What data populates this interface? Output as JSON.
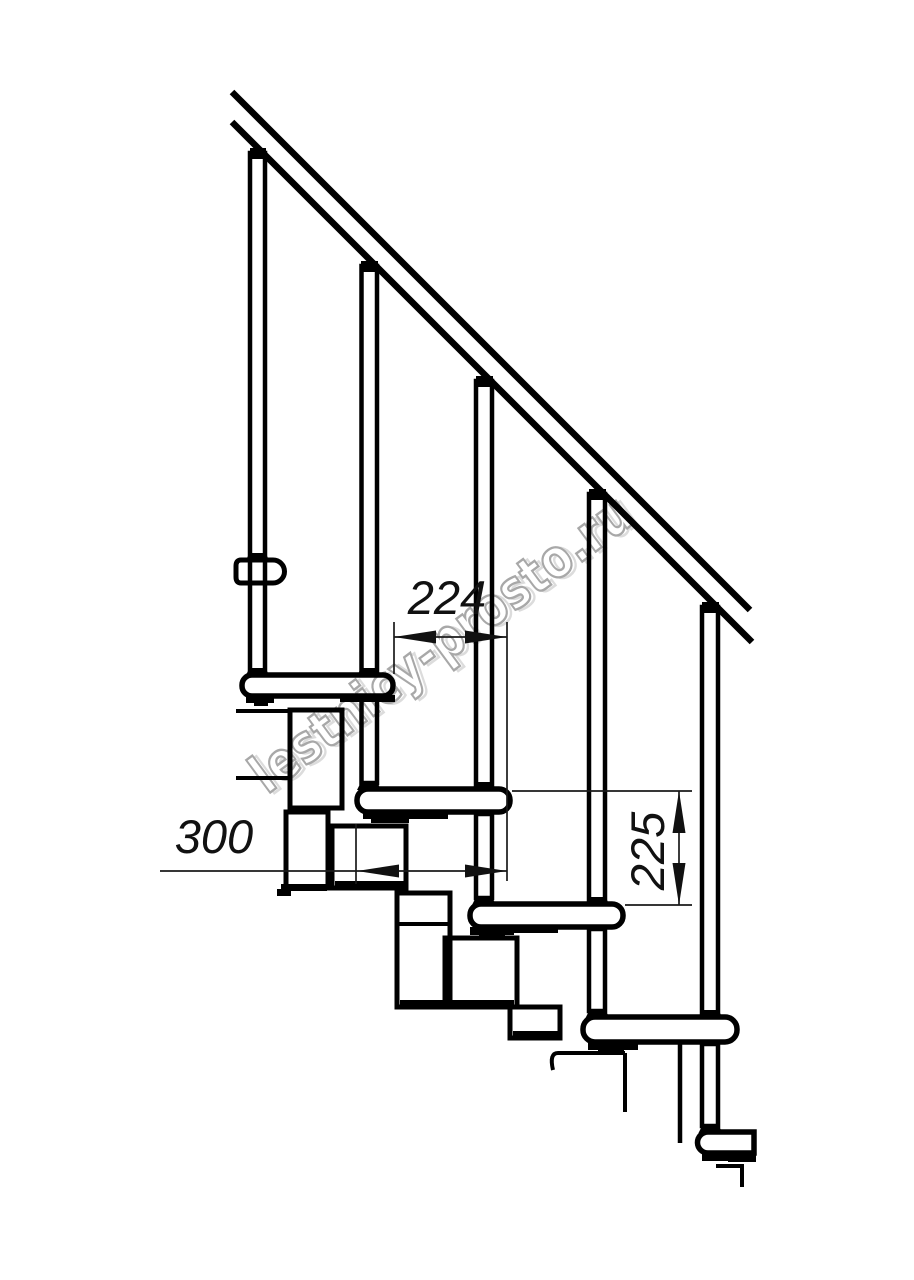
{
  "drawing": {
    "title": "Modular staircase side-view technical drawing",
    "dimensions": {
      "step_run": "224",
      "tread_depth": "300",
      "riser_height": "225"
    },
    "watermark": {
      "text": "lestnicy-prosto.ru",
      "color": "#a8a8a8"
    },
    "colors": {
      "line": "#000000",
      "background": "#ffffff"
    }
  }
}
